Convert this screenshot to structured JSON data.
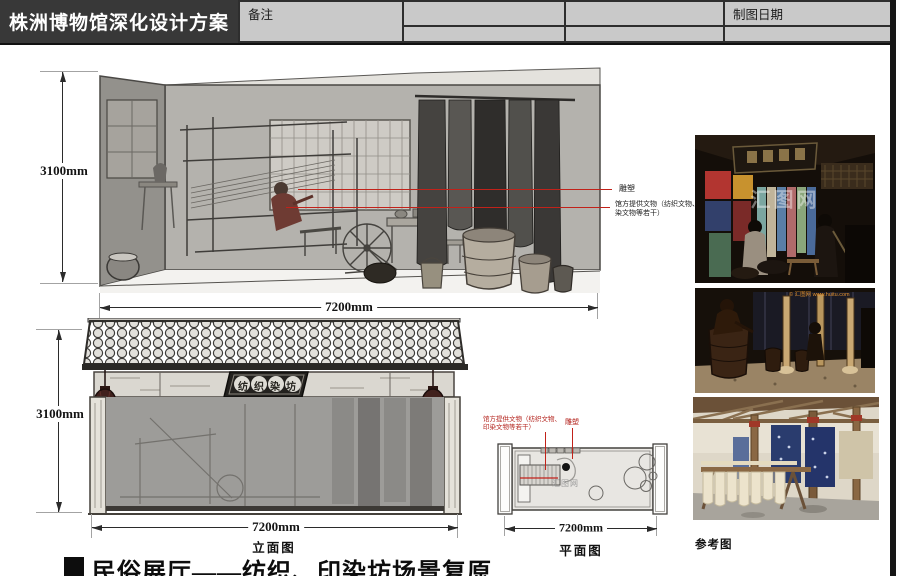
{
  "header": {
    "title": "株洲博物馆深化设计方案",
    "drawing_date_label": "制图日期",
    "remarks_label": "备注"
  },
  "elevation1": {
    "height_dim": "3100mm",
    "width_dim": "7200mm",
    "annotation_sculpture": "雕塑",
    "annotation_artifacts": "馆方提供文物（纺织文物、印染文物等若干）"
  },
  "elevation2": {
    "height_dim": "3100mm",
    "width_dim": "7200mm",
    "label": "立面图",
    "sign_text": "纺织染坊"
  },
  "plan": {
    "width_dim": "7200mm",
    "label": "平面图",
    "annotation_artifacts_line1": "馆方提供文物（纺织文物、",
    "annotation_artifacts_line2": "印染文物等若干）",
    "annotation_sculpture": "雕塑",
    "watermark": "汇图网"
  },
  "photos": {
    "section_label": "参考图",
    "watermark_center": "汇图网",
    "watermark_copyright": "© 汇图网 www.huitu.com"
  },
  "caption": {
    "text": "民俗展厅——纺织、印染坊场景复原"
  },
  "colors": {
    "annotation_red": "#c1221a",
    "header_bg": "#383838",
    "table_cell_bg": "#c9c9c9"
  }
}
